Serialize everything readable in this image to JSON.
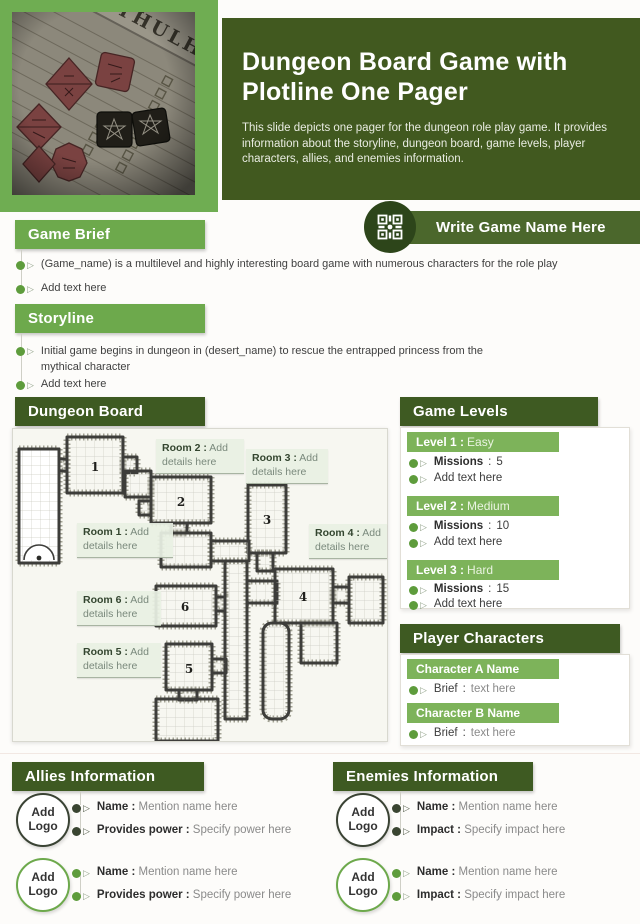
{
  "colors": {
    "green_dark": "#3E5A22",
    "green_mid": "#6DA94C",
    "green_light": "#7DB35A",
    "banner_circle": "#2D451A",
    "bullet_green": "#5E9C3C",
    "bullet_dark": "#3A4531"
  },
  "header": {
    "title": "Dungeon Board Game with Plotline One Pager",
    "description": "This slide depicts one pager for the dungeon role play game. It provides information about the storyline, dungeon board, game levels, player characters, allies, and enemies information.",
    "photo_text": "ZEW CTHULHU"
  },
  "game_name_banner": {
    "label": "Write Game Name Here",
    "icon": "qr-code-icon"
  },
  "labels": {
    "colon": ":"
  },
  "game_brief": {
    "heading": "Game Brief",
    "bullets": [
      "(Game_name) is a multilevel and highly interesting board game with numerous characters for the role play",
      "Add text here"
    ]
  },
  "storyline": {
    "heading": "Storyline",
    "bullets": [
      "Initial game begins in dungeon in (desert_name) to rescue the entrapped princess from the mythical character",
      "Add text here"
    ]
  },
  "dungeon_board": {
    "heading": "Dungeon Board",
    "rooms": [
      {
        "number": "1",
        "label": "Room 1 :",
        "detail": "Add details here"
      },
      {
        "number": "2",
        "label": "Room 2 :",
        "detail": "Add details here"
      },
      {
        "number": "3",
        "label": "Room 3 :",
        "detail": "Add details here"
      },
      {
        "number": "4",
        "label": "Room 4 :",
        "detail": "Add details here"
      },
      {
        "number": "5",
        "label": "Room 5 :",
        "detail": "Add details here"
      },
      {
        "number": "6",
        "label": "Room 6 :",
        "detail": "Add details here"
      }
    ]
  },
  "game_levels": {
    "heading": "Game Levels",
    "levels": [
      {
        "name": "Level 1 :",
        "difficulty": "Easy",
        "missions_label": "Missions",
        "missions_value": "5",
        "note": "Add text here"
      },
      {
        "name": "Level 2 :",
        "difficulty": "Medium",
        "missions_label": "Missions",
        "missions_value": "10",
        "note": "Add text here"
      },
      {
        "name": "Level 3 :",
        "difficulty": "Hard",
        "missions_label": "Missions",
        "missions_value": "15",
        "note": "Add text here"
      }
    ]
  },
  "player_characters": {
    "heading": "Player Characters",
    "characters": [
      {
        "name": "Character A Name",
        "brief_label": "Brief",
        "brief_value": "text here"
      },
      {
        "name": "Character B Name",
        "brief_label": "Brief",
        "brief_value": "text here"
      }
    ]
  },
  "allies": {
    "heading": "Allies Information",
    "entries": [
      {
        "logo_label": "Add Logo",
        "name_label": "Name :",
        "name_value": "Mention name here",
        "power_label": "Provides power :",
        "power_value": "Specify power here"
      },
      {
        "logo_label": "Add Logo",
        "name_label": "Name :",
        "name_value": "Mention name here",
        "power_label": "Provides power :",
        "power_value": "Specify power here"
      }
    ]
  },
  "enemies": {
    "heading": "Enemies Information",
    "entries": [
      {
        "logo_label": "Add Logo",
        "name_label": "Name :",
        "name_value": "Mention name here",
        "impact_label": "Impact :",
        "impact_value": "Specify impact here"
      },
      {
        "logo_label": "Add Logo",
        "name_label": "Name :",
        "name_value": "Mention name here",
        "impact_label": "Impact :",
        "impact_value": "Specify impact here"
      }
    ]
  }
}
